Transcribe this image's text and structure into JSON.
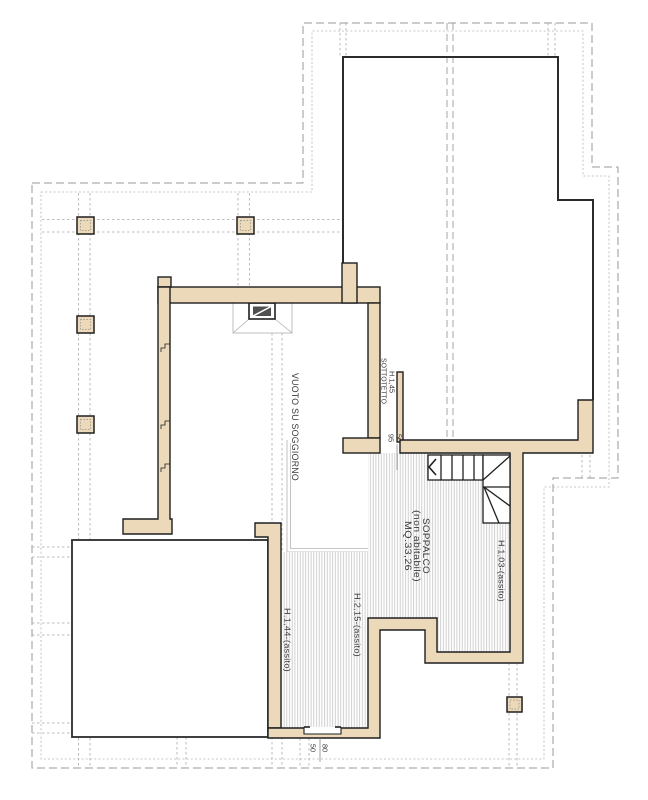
{
  "drawing": {
    "room_labels": {
      "void_room": "VUOTO  SU  SOGGIORNO",
      "attic_height": "H.1,45",
      "attic_name": "SOTTOTETTO",
      "mezzanine_name": "SOPPALCO",
      "mezzanine_note": "(non abitabile)",
      "mezzanine_area": "MQ.33,26",
      "height_east_wall": "H.1,03-(assito)",
      "height_left_wall": "H.1,44-(assito)",
      "height_corridor": "H.2,15-(assito)"
    },
    "dimensions": {
      "opening_width": "50",
      "opening_side": "95",
      "door_width": "80",
      "door_side": "50"
    },
    "colors": {
      "wall_fill": "#ecd9ba",
      "wall_stroke": "#1f1f1f",
      "outline": "#2b2b2b",
      "dashed_boundary": "#9a9a9a",
      "grid": "#a8a8a8",
      "hatch": "#c5c5c5",
      "text": "#3a3a3a"
    }
  }
}
